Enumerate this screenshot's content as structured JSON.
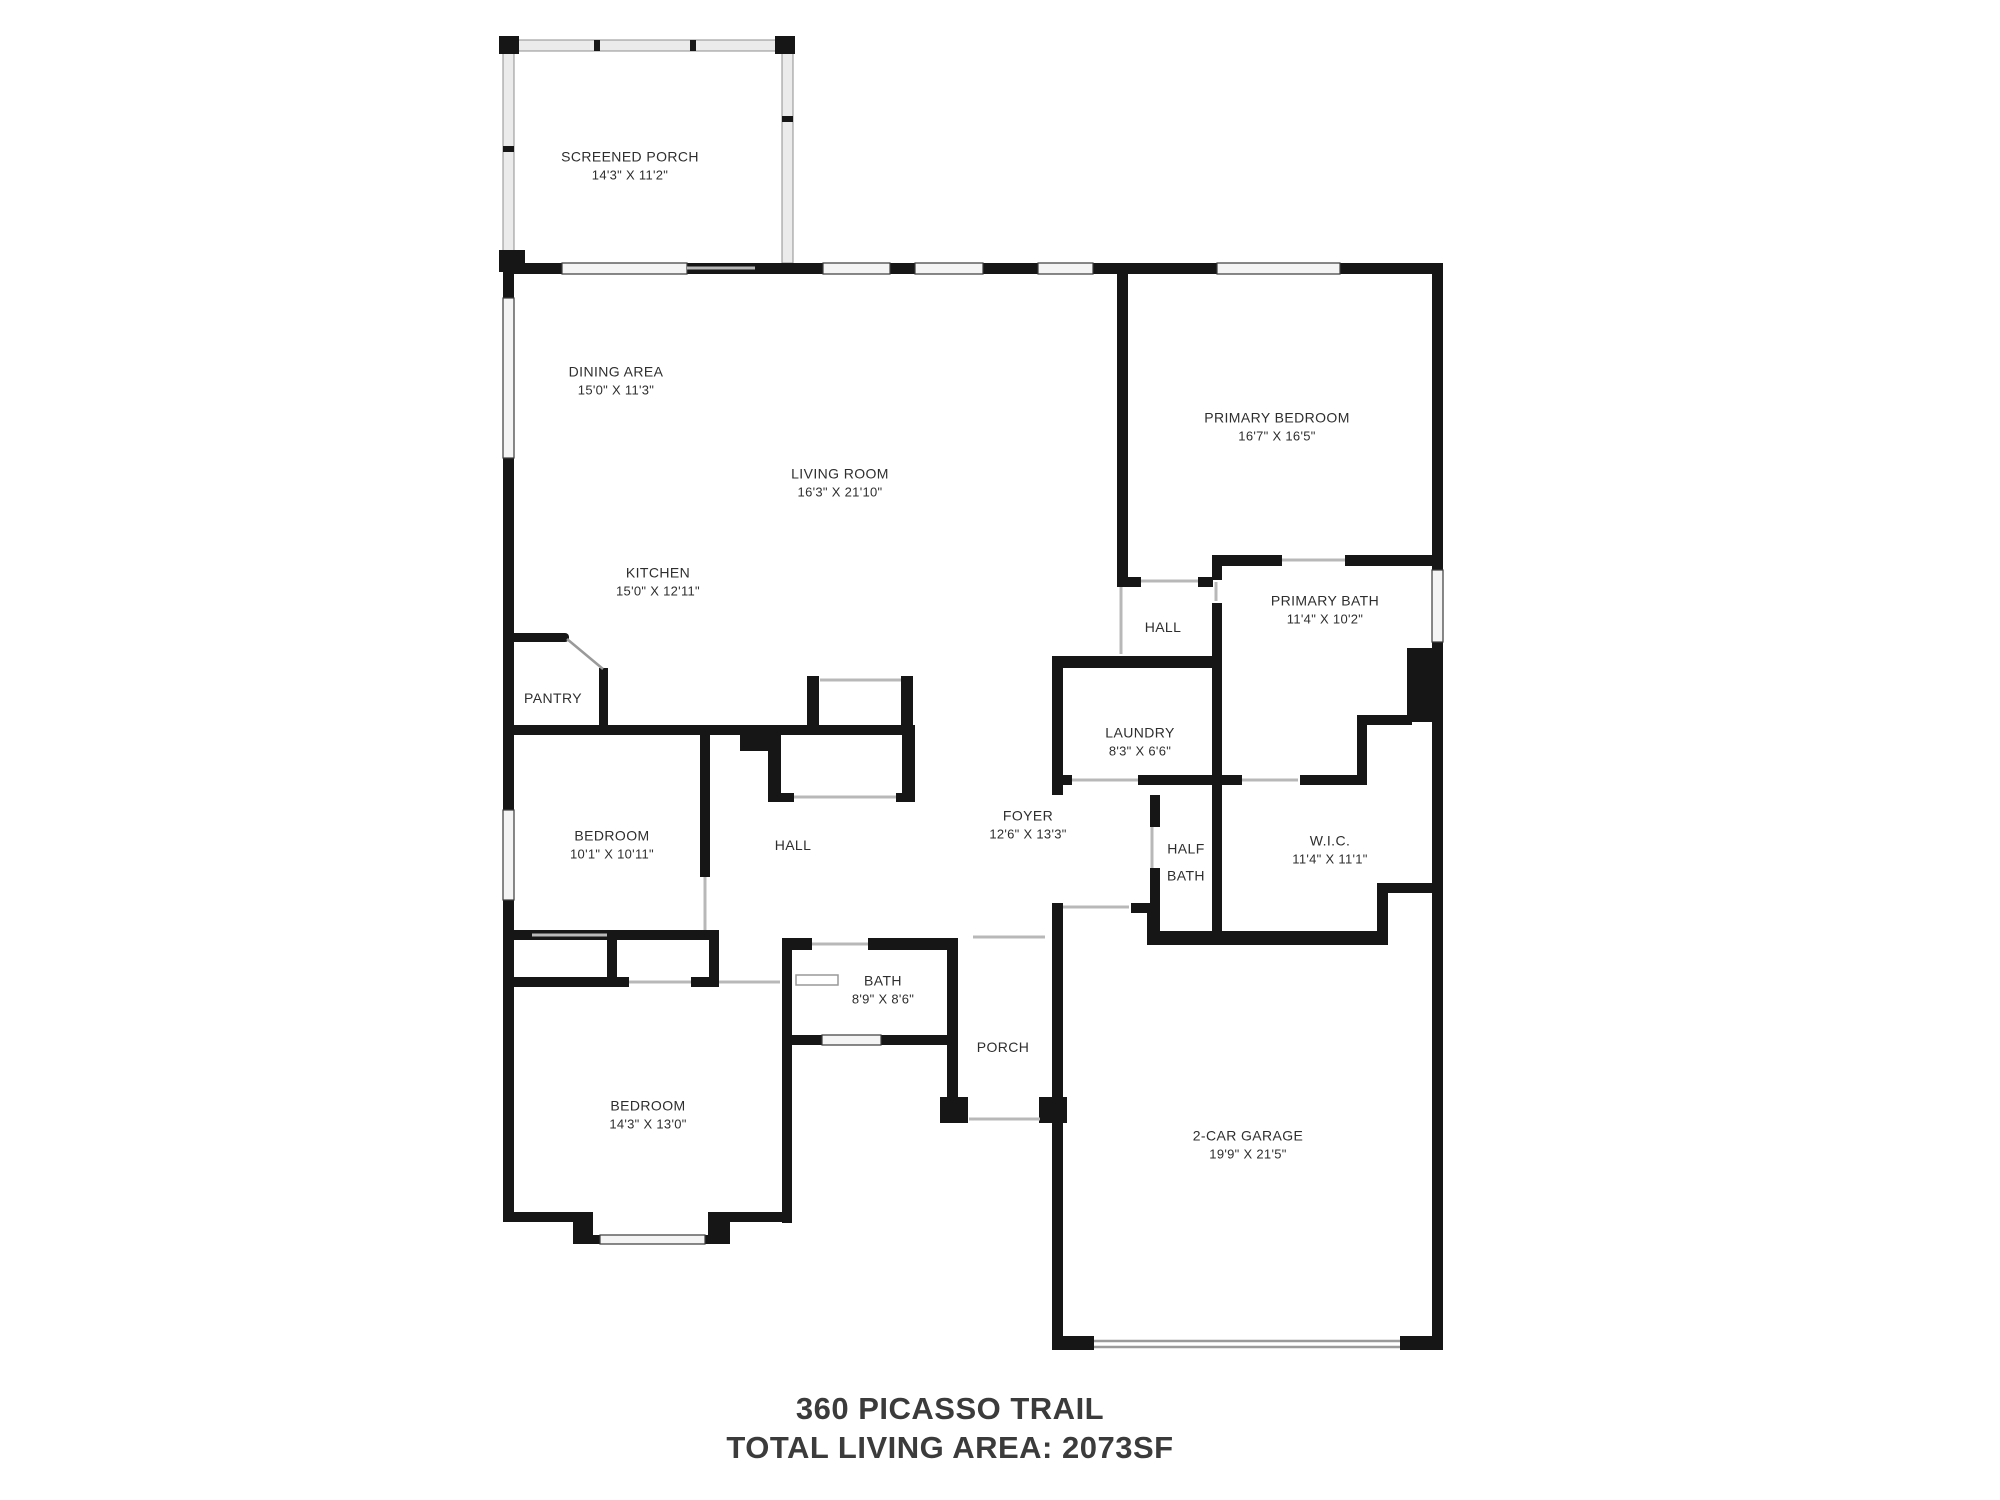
{
  "title": {
    "address": "360 PICASSO TRAIL",
    "total_area": "TOTAL LIVING AREA: 2073SF"
  },
  "rooms": [
    {
      "id": "screened-porch",
      "name": "SCREENED PORCH",
      "dims": "14'3\" X 11'2\""
    },
    {
      "id": "dining-area",
      "name": "DINING AREA",
      "dims": "15'0\" X 11'3\""
    },
    {
      "id": "living-room",
      "name": "LIVING ROOM",
      "dims": "16'3\" X 21'10\""
    },
    {
      "id": "primary-bedroom",
      "name": "PRIMARY BEDROOM",
      "dims": "16'7\" X 16'5\""
    },
    {
      "id": "kitchen",
      "name": "KITCHEN",
      "dims": "15'0\" X 12'11\""
    },
    {
      "id": "hall-upper",
      "name": "HALL",
      "dims": ""
    },
    {
      "id": "primary-bath",
      "name": "PRIMARY BATH",
      "dims": "11'4\" X 10'2\""
    },
    {
      "id": "pantry",
      "name": "PANTRY",
      "dims": ""
    },
    {
      "id": "laundry",
      "name": "LAUNDRY",
      "dims": "8'3\" X 6'6\""
    },
    {
      "id": "bedroom-1",
      "name": "BEDROOM",
      "dims": "10'1\" X 10'11\""
    },
    {
      "id": "hall-lower",
      "name": "HALL",
      "dims": ""
    },
    {
      "id": "foyer",
      "name": "FOYER",
      "dims": "12'6\" X 13'3\""
    },
    {
      "id": "half-bath",
      "name": "HALF BATH",
      "dims": ""
    },
    {
      "id": "wic",
      "name": "W.I.C.",
      "dims": "11'4\" X 11'1\""
    },
    {
      "id": "bath",
      "name": "BATH",
      "dims": "8'9\" X 8'6\""
    },
    {
      "id": "porch",
      "name": "PORCH",
      "dims": ""
    },
    {
      "id": "bedroom-2",
      "name": "BEDROOM",
      "dims": "14'3\" X 13'0\""
    },
    {
      "id": "garage",
      "name": "2-CAR GARAGE",
      "dims": "19'9\" X 21'5\""
    }
  ]
}
